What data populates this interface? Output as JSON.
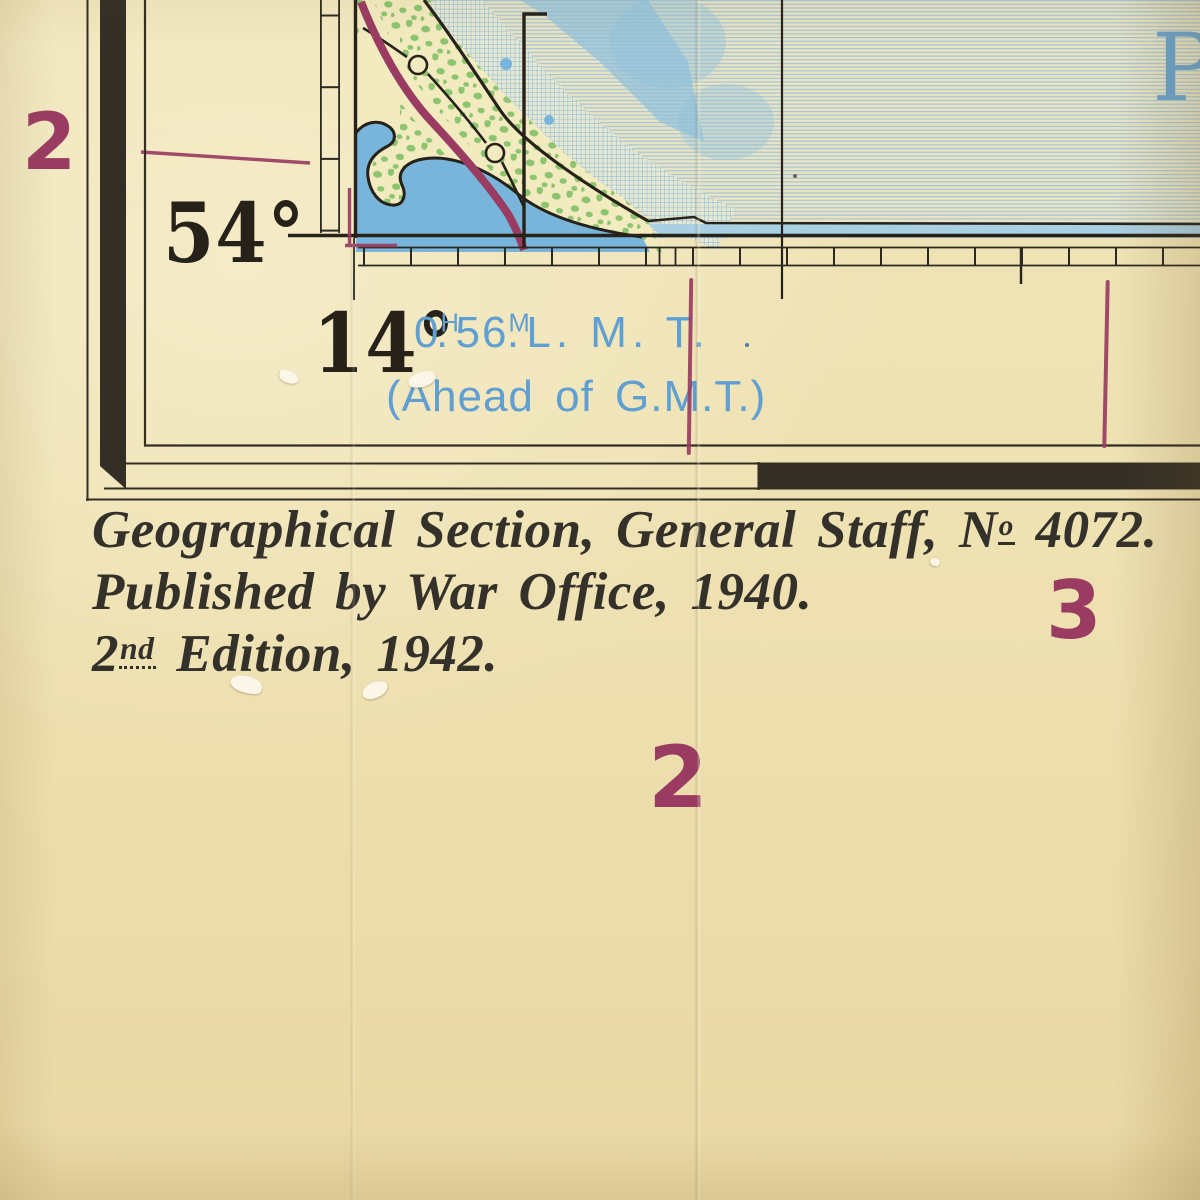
{
  "sheet": {
    "latitude_label": "54°",
    "longitude_label": "14°",
    "time_note": {
      "hours": "0",
      "hours_unit": "H",
      "h_dot": ".",
      "minutes": "56",
      "minutes_unit": "M",
      "m_dot": ".",
      "zone": "L. M. T.",
      "parenthetical": "(Ahead of G.M.T.)"
    },
    "grid_numbers": {
      "row_left": "2",
      "column_bottom": "2",
      "column_right": "3"
    },
    "sea_name_partial_letter": "P"
  },
  "imprint": {
    "line1_text": "Geographical Section, General Staff, N",
    "line1_numero_sup": "o",
    "line1_number": " 4072.",
    "line2": "Published by War Office, 1940.",
    "line3_leading": "2",
    "line3_sup": "nd",
    "line3_rest": " Edition, 1942."
  },
  "colors": {
    "paper": "#eddfb0",
    "ink": "#2c2822",
    "maroon_overprint": "#9a3c62",
    "water_blue": "#79b5da",
    "sea_line_blue": "#a2c5d8",
    "vegetation_green": "#8cc470",
    "hydro_text_blue": "#5f9fd2"
  }
}
